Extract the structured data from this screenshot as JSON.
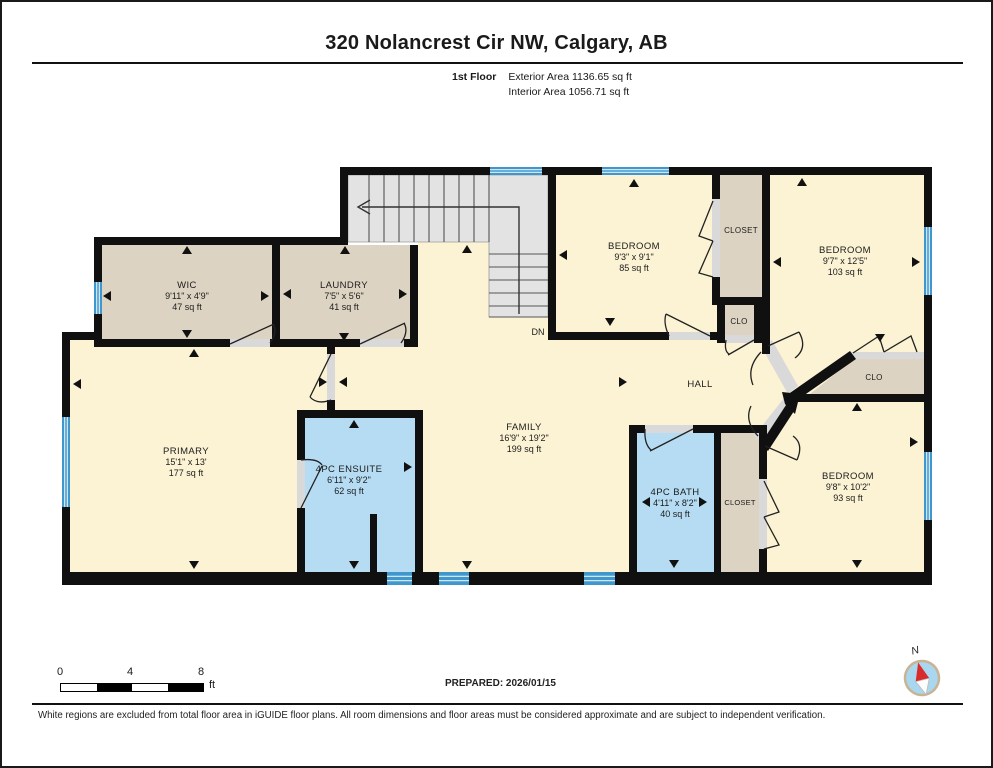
{
  "header": {
    "title": "320 Nolancrest Cir NW, Calgary, AB",
    "floor_label": "1st Floor",
    "exterior_area": "Exterior Area 1136.65 sq ft",
    "interior_area": "Interior Area 1056.71 sq ft"
  },
  "rooms": {
    "wic": {
      "name": "WIC",
      "dims": "9'11\" x 4'9\"",
      "area": "47 sq ft"
    },
    "laundry": {
      "name": "LAUNDRY",
      "dims": "7'5\" x 5'6\"",
      "area": "41 sq ft"
    },
    "bedroom2": {
      "name": "BEDROOM",
      "dims": "9'3\" x 9'1\"",
      "area": "85 sq ft"
    },
    "bedroom3": {
      "name": "BEDROOM",
      "dims": "9'7\" x 12'5\"",
      "area": "103 sq ft"
    },
    "bedroom4": {
      "name": "BEDROOM",
      "dims": "9'8\" x 10'2\"",
      "area": "93 sq ft"
    },
    "primary": {
      "name": "PRIMARY",
      "dims": "15'1\" x 13'",
      "area": "177 sq ft"
    },
    "ensuite": {
      "name": "4PC ENSUITE",
      "dims": "6'11\" x 9'2\"",
      "area": "62 sq ft"
    },
    "family": {
      "name": "FAMILY",
      "dims": "16'9\" x 19'2\"",
      "area": "199 sq ft"
    },
    "bath": {
      "name": "4PC BATH",
      "dims": "4'11\" x 8'2\"",
      "area": "40 sq ft"
    },
    "hall": {
      "name": "HALL"
    },
    "closet_upper": {
      "name": "CLOSET"
    },
    "closet_lower": {
      "name": "CLOSET"
    },
    "clo_hall": {
      "name": "CLO"
    },
    "clo_bedroom3": {
      "name": "CLO"
    },
    "stairs": {
      "down_label": "DN"
    }
  },
  "footer": {
    "scale": {
      "start": "0",
      "mid": "4",
      "end": "8",
      "unit": "ft"
    },
    "prepared": "PREPARED: 2026/01/15",
    "compass_label": "N",
    "disclaimer": "White regions are excluded from total floor area in iGUIDE floor plans. All room dimensions and floor areas must be considered approximate and are subject to independent verification."
  },
  "colors": {
    "wall": "#101010",
    "room_fill": "#fcf3d4",
    "utility_fill": "#ddd3c2",
    "bath_fill": "#b5dcf2",
    "stairs_fill": "#e3e3e3",
    "threshold": "#d9d9d9",
    "window": "#3f97cc",
    "window_stripe": "#d6ecf8",
    "compass_face": "#a9d7f0",
    "compass_ring": "#c9b393",
    "compass_needle": "#d92b2b"
  }
}
